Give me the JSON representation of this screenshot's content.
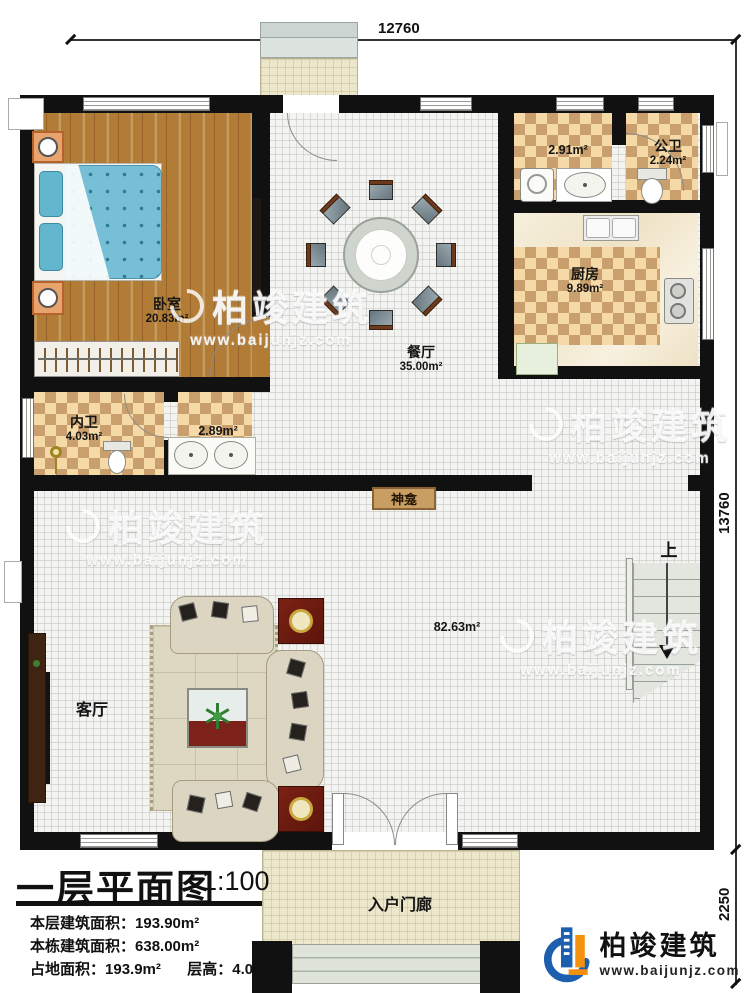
{
  "dims": {
    "top": "12760",
    "right_main": "13760",
    "right_porch": "2250"
  },
  "rooms": {
    "bedroom": {
      "name": "卧室",
      "area": "20.83m²"
    },
    "dining": {
      "name": "餐厅",
      "area": "35.00m²"
    },
    "laundry": {
      "area": "2.91m²"
    },
    "public_bath": {
      "name": "公卫",
      "area": "2.24m²"
    },
    "kitchen": {
      "name": "厨房",
      "area": "9.89m²"
    },
    "private_bath": {
      "name": "内卫",
      "area": "4.03m²"
    },
    "vanity": {
      "area": "2.89m²"
    },
    "living": {
      "name": "客厅",
      "area": "82.63m²"
    },
    "shrine": {
      "name": "神龛"
    },
    "stairs": {
      "label": "上"
    },
    "porch": {
      "name": "入户门廊"
    }
  },
  "titleblock": {
    "title": "一层平面图",
    "scale": "1:100",
    "lines": [
      {
        "label": "本层建筑面积：",
        "value": "193.90m²"
      },
      {
        "label": "本栋建筑面积：",
        "value": "638.00m²"
      },
      {
        "label": "占地面积：",
        "value": "193.9m²"
      },
      {
        "label": "层高：",
        "value": "4.0m"
      }
    ]
  },
  "branding": {
    "watermark_brand": "柏竣建筑",
    "watermark_url": "www.baijunjz.com",
    "logo_brand": "柏竣建筑",
    "logo_url": "www.baijunjz.com"
  },
  "colors": {
    "wall": "#111111",
    "wood": "#b27c36",
    "checker_light": "#f5d9a6",
    "checker_dark": "#c9a06d",
    "logo_blue": "#1b5fae",
    "logo_orange": "#f5900f"
  }
}
